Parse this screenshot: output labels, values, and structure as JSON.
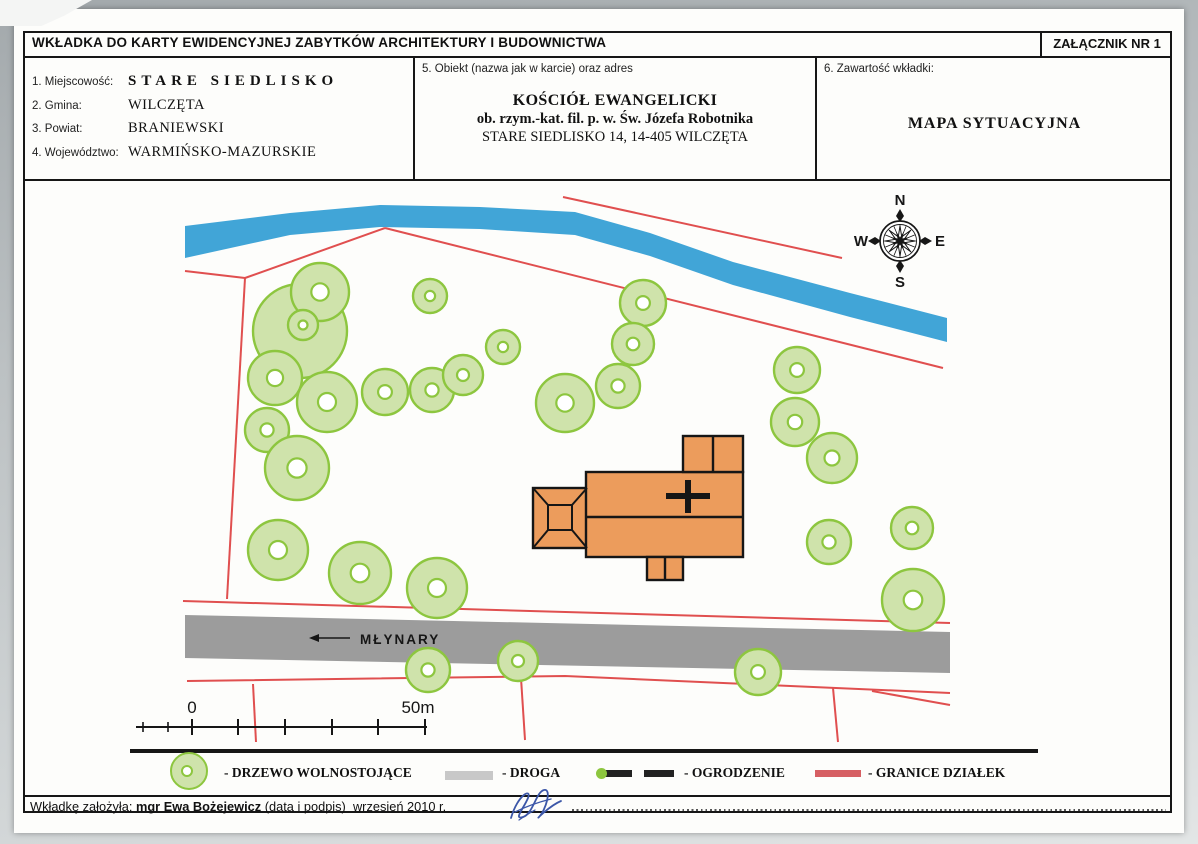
{
  "page": {
    "title": "WKŁADKA DO KARTY EWIDENCYJNEJ ZABYTKÓW ARCHITEKTURY I BUDOWNICTWA",
    "attachment_label": "ZAŁĄCZNIK NR 1"
  },
  "fields": {
    "f1_label": "1. Miejscowość:",
    "f1_value": "STARE SIEDLISKO",
    "f2_label": "2. Gmina:",
    "f2_value": "WILCZĘTA",
    "f3_label": "3. Powiat:",
    "f3_value": "BRANIEWSKI",
    "f4_label": "4. Województwo:",
    "f4_value": "WARMIŃSKO-MAZURSKIE",
    "f5_label": "5. Obiekt (nazwa jak w karcie) oraz adres",
    "f5_line1": "KOŚCIÓŁ EWANGELICKI",
    "f5_line2": "ob. rzym.-kat. fil. p. w. Św. Józefa Robotnika",
    "f5_line3": "STARE SIEDLISKO 14, 14-405 WILCZĘTA",
    "f6_label": "6. Zawartość wkładki:",
    "f6_value": "MAPA SYTUACYJNA"
  },
  "map": {
    "colors": {
      "tree_fill": "#cfe3ab",
      "tree_stroke": "#8dc63f",
      "river": "#41a5d7",
      "road": "#9c9c9c",
      "building": "#ec9c5c",
      "parcel_line": "#e04f4f",
      "outline": "#161616"
    },
    "compass": {
      "cx": 900,
      "cy": 241,
      "n": "N",
      "s": "S",
      "e": "E",
      "w": "W"
    },
    "road_label": {
      "text": "MŁYNARY",
      "x": 360,
      "y": 644,
      "arrow_x1": 350,
      "arrow_x2": 318,
      "arrow_y": 638
    },
    "scale": {
      "x1": 136,
      "x2": 427,
      "y": 727,
      "small_ticks": [
        143,
        168
      ],
      "big_ticks": [
        192,
        238,
        285,
        332,
        378,
        425
      ],
      "start_label": "0",
      "end_label": "50m",
      "label0_x": 192,
      "label50_x": 418
    },
    "river": [
      [
        185,
        226
      ],
      [
        290,
        213
      ],
      [
        380,
        205
      ],
      [
        480,
        207
      ],
      [
        575,
        212
      ],
      [
        650,
        233
      ],
      [
        733,
        262
      ],
      [
        850,
        293
      ],
      [
        947,
        318
      ],
      [
        947,
        342
      ],
      [
        850,
        317
      ],
      [
        733,
        285
      ],
      [
        650,
        256
      ],
      [
        575,
        235
      ],
      [
        480,
        229
      ],
      [
        380,
        227
      ],
      [
        290,
        235
      ],
      [
        185,
        258
      ]
    ],
    "road": [
      [
        185,
        615
      ],
      [
        950,
        632
      ],
      [
        950,
        673
      ],
      [
        185,
        658
      ]
    ],
    "parcel_lines": [
      [
        [
          185,
          271
        ],
        [
          245,
          278
        ]
      ],
      [
        [
          245,
          278
        ],
        [
          385,
          228
        ]
      ],
      [
        [
          385,
          228
        ],
        [
          943,
          368
        ]
      ],
      [
        [
          563,
          197
        ],
        [
          842,
          258
        ]
      ],
      [
        [
          245,
          278
        ],
        [
          227,
          599
        ]
      ],
      [
        [
          183,
          601
        ],
        [
          950,
          623
        ]
      ],
      [
        [
          187,
          681
        ],
        [
          565,
          676
        ],
        [
          950,
          693
        ]
      ],
      [
        [
          253,
          684
        ],
        [
          256,
          742
        ]
      ],
      [
        [
          521,
          678
        ],
        [
          525,
          740
        ]
      ],
      [
        [
          833,
          688
        ],
        [
          838,
          742
        ]
      ],
      [
        [
          872,
          691
        ],
        [
          950,
          705
        ]
      ]
    ],
    "trees": [
      {
        "x": 300,
        "y": 331,
        "r": 47,
        "hole": false
      },
      {
        "x": 320,
        "y": 292,
        "r": 29,
        "hole": true
      },
      {
        "x": 303,
        "y": 325,
        "r": 15,
        "hole": true
      },
      {
        "x": 430,
        "y": 296,
        "r": 17,
        "hole": true
      },
      {
        "x": 503,
        "y": 347,
        "r": 17,
        "hole": true
      },
      {
        "x": 643,
        "y": 303,
        "r": 23,
        "hole": true
      },
      {
        "x": 633,
        "y": 344,
        "r": 21,
        "hole": true
      },
      {
        "x": 618,
        "y": 386,
        "r": 22,
        "hole": true
      },
      {
        "x": 275,
        "y": 378,
        "r": 27,
        "hole": true
      },
      {
        "x": 327,
        "y": 402,
        "r": 30,
        "hole": true
      },
      {
        "x": 385,
        "y": 392,
        "r": 23,
        "hole": true
      },
      {
        "x": 432,
        "y": 390,
        "r": 22,
        "hole": true
      },
      {
        "x": 463,
        "y": 375,
        "r": 20,
        "hole": true
      },
      {
        "x": 267,
        "y": 430,
        "r": 22,
        "hole": true
      },
      {
        "x": 297,
        "y": 468,
        "r": 32,
        "hole": true
      },
      {
        "x": 278,
        "y": 550,
        "r": 30,
        "hole": true
      },
      {
        "x": 360,
        "y": 573,
        "r": 31,
        "hole": true
      },
      {
        "x": 437,
        "y": 588,
        "r": 30,
        "hole": true
      },
      {
        "x": 565,
        "y": 403,
        "r": 29,
        "hole": true
      },
      {
        "x": 797,
        "y": 370,
        "r": 23,
        "hole": true
      },
      {
        "x": 795,
        "y": 422,
        "r": 24,
        "hole": true
      },
      {
        "x": 832,
        "y": 458,
        "r": 25,
        "hole": true
      },
      {
        "x": 829,
        "y": 542,
        "r": 22,
        "hole": true
      },
      {
        "x": 912,
        "y": 528,
        "r": 21,
        "hole": true
      },
      {
        "x": 913,
        "y": 600,
        "r": 31,
        "hole": true
      },
      {
        "x": 428,
        "y": 670,
        "r": 22,
        "hole": true
      },
      {
        "x": 518,
        "y": 661,
        "r": 20,
        "hole": true
      },
      {
        "x": 758,
        "y": 672,
        "r": 23,
        "hole": true
      }
    ],
    "church": {
      "main": [
        586,
        472,
        157,
        85
      ],
      "divider_y": 517,
      "top_annex": [
        683,
        436,
        60,
        36
      ],
      "top_annex_divider_x": 713,
      "bottom_annex": [
        647,
        557,
        36,
        23
      ],
      "bottom_annex_divider_x": 665,
      "tower_outer": [
        533,
        488,
        54,
        60
      ],
      "tower_inner": [
        548,
        505,
        24,
        25
      ],
      "cross": {
        "cx": 688,
        "cy": 496,
        "x1": 666,
        "x2": 710,
        "y1": 480,
        "y2": 513,
        "w": 6
      }
    }
  },
  "legend": {
    "items": [
      {
        "symbol": "tree",
        "label": "- DRZEWO  WOLNOSTOJĄCE"
      },
      {
        "symbol": "road",
        "label": "- DROGA"
      },
      {
        "symbol": "fence",
        "label": "- OGRODZENIE"
      },
      {
        "symbol": "boundary",
        "label": "- GRANICE DZIAŁEK"
      }
    ]
  },
  "footer": {
    "prefix": "Wkładkę założyła:",
    "author": "mgr Ewa Bożejewicz",
    "note": "(data i podpis)",
    "date": "wrzesień 2010 r."
  }
}
